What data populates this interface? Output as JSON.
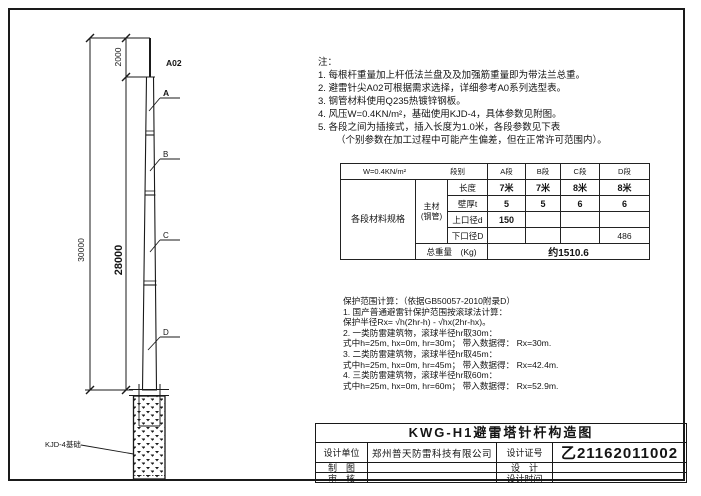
{
  "drawing": {
    "tip_label": "A02",
    "labels": {
      "a": "A",
      "b": "B",
      "c": "C",
      "d": "D"
    },
    "dims": {
      "overall": "30000",
      "pole": "28000",
      "tip": "2000"
    },
    "foundation_label": "KJD-4基础"
  },
  "notes": {
    "title": "注：",
    "items": [
      "1. 每根杆重量加上杆低法兰盘及及加强筋重量即为带法兰总重。",
      "2. 避雷针尖A02可根据需求选择，详细参考A0系列选型表。",
      "3. 钢管材料使用Q235热镀锌钢板。",
      "4. 风压W=0.4KN/m²，基础使用KJD-4，具体参数见附图。",
      "5. 各段之间为插接式，插入长度为1.0米，各段参数见下表",
      "（个别参数在加工过程中可能产生偏差，但在正常许可范围内）。"
    ]
  },
  "spec_table": {
    "header": {
      "wind": "W=0.4KN/m²",
      "col_label": "段别",
      "segments": [
        "A段",
        "B段",
        "C段",
        "D段"
      ]
    },
    "side_label": "各段材料规格",
    "group_label_1": "主材",
    "group_label_2": "(钢管)",
    "rows": [
      {
        "label": "长度",
        "values": [
          "7米",
          "7米",
          "8米",
          "8米"
        ]
      },
      {
        "label": "壁厚t",
        "values": [
          "5",
          "5",
          "6",
          "6"
        ]
      },
      {
        "label": "上口径d",
        "values": [
          "150",
          "",
          "",
          ""
        ]
      },
      {
        "label": "下口径D",
        "values": [
          "",
          "",
          "",
          "486"
        ]
      }
    ],
    "total_label": "总重量　(Kg)",
    "total_value": "约1510.6"
  },
  "calc": {
    "title": "保护范围计算：（依据GB50057-2010附录D）",
    "lines": [
      "1. 国产普通避雷针保护范围按滚球法计算：",
      "保护半径Rx= √h(2hr-h) - √hx(2hr-hx)。",
      "2. 一类防雷建筑物，滚球半径hr取30m：",
      "式中h=25m, hx=0m, hr=30m； 带入数据得： Rx=30m.",
      "3. 二类防雷建筑物，滚球半径hr取45m：",
      "式中h=25m, hx=0m, hr=45m； 带入数据得： Rx=42.4m.",
      "4. 三类防雷建筑物，滚球半径hr取60m：",
      "式中h=25m, hx=0m, hr=60m； 带入数据得： Rx=52.9m."
    ]
  },
  "title_block": {
    "title": "KWG-H1避雷塔针杆构造图",
    "design_unit_label": "设计单位",
    "design_unit": "郑州普天防雷科技有限公司",
    "cert_label": "设计证号",
    "cert_no": "乙21162011002",
    "draft_label": "制　图",
    "design_label": "设　计",
    "review_label": "审　核",
    "date_label": "设计时间",
    "draft_value": "",
    "design_value": "",
    "review_value": "",
    "date_value": ""
  }
}
